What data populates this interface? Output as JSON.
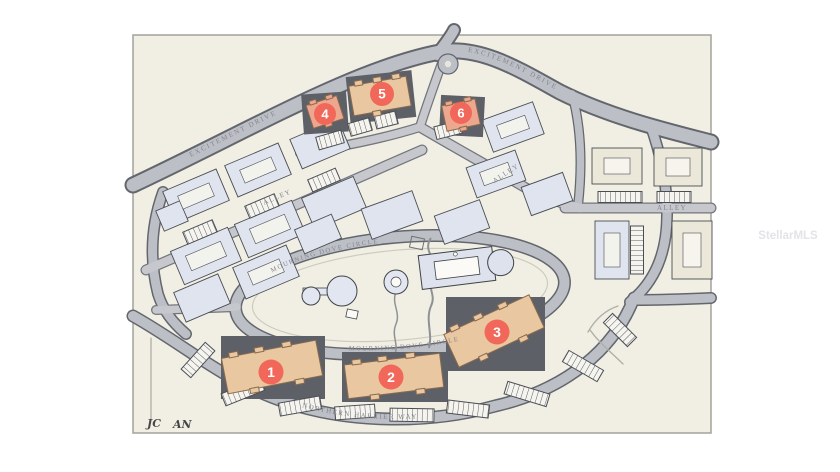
{
  "page": {
    "watermark": "StellarMLS"
  },
  "plan": {
    "signature_left": "JC",
    "signature_right": "AN",
    "roads": {
      "excitement_left": "EXCITEMENT DRIVE",
      "excitement_right": "EXCITEMENT DRIVE",
      "alley_left": "ALLEY",
      "alley_upper_right": "ALLEY",
      "alley_right": "ALLEY",
      "mourning_dove_top": "MOURNING DOVE CIRCLE",
      "mourning_dove_bottom": "MOURNING DOVE CIRCLE",
      "northern_harrier": "NORTHERN HARRIER WAY"
    },
    "markers": [
      {
        "number": "1"
      },
      {
        "number": "2"
      },
      {
        "number": "3"
      },
      {
        "number": "4"
      },
      {
        "number": "5"
      },
      {
        "number": "6"
      }
    ],
    "colors": {
      "map_background": "#f1efe4",
      "map_border": "#a3a29a",
      "road_fill": "#bdbfc6",
      "road_casing": "#63666d",
      "building_blue": "#dfe4ee",
      "building_cream": "#ebe7d9",
      "building_stroke": "#4a4d53",
      "highlight_backdrop": "#5d6167",
      "highlight_tan": "#e9c7a0",
      "highlight_salmon": "#eda78f",
      "marker_red": "#f1685a",
      "stall_bg": "#f5f4ef",
      "label_gray": "#85868d"
    }
  }
}
